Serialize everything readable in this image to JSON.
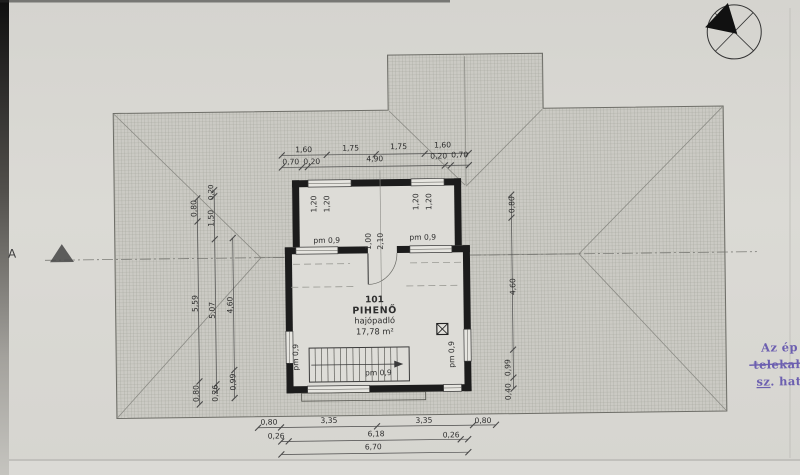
{
  "labels": {
    "pm": "pm 0,9",
    "section_marker": "A"
  },
  "room": {
    "number": "101",
    "name": "PIHENŐ",
    "flooring": "hajópadló",
    "area": "17,78 m²"
  },
  "dimensions": {
    "top_row1": [
      "1,60",
      "1,75",
      "1,75",
      "1,60"
    ],
    "top_row2": [
      "0,70",
      "0,20",
      "4,90",
      "0,20",
      "0,70"
    ],
    "left_col1": [
      "0,80",
      "5,59",
      "0,80"
    ],
    "left_col2": [
      "0,20",
      "1,50",
      "5,07",
      "0,26"
    ],
    "left_col3": [
      "4,60",
      "0,99"
    ],
    "right_col": [
      "0,80",
      "4,60",
      "0,99",
      "0,40"
    ],
    "windows_left": [
      "1,20",
      "1,20"
    ],
    "windows_right": [
      "1,20",
      "1,20"
    ],
    "door": [
      "1,00",
      "2,10"
    ],
    "bottom_row1": [
      "0,80",
      "3,35",
      "3,35",
      "0,80"
    ],
    "bottom_row2": [
      "0,26",
      "6,18",
      "0,26"
    ],
    "bottom_total": "6,70"
  },
  "stamp": {
    "line1": "Az ép",
    "line2": "telekal",
    "line3": "sz. hat"
  },
  "colors": {
    "paper": "#d8d7d2",
    "hatch_base": "#cbcac4",
    "wall": "#1c1c1c",
    "stamp_ink": "#6c5fb0"
  }
}
